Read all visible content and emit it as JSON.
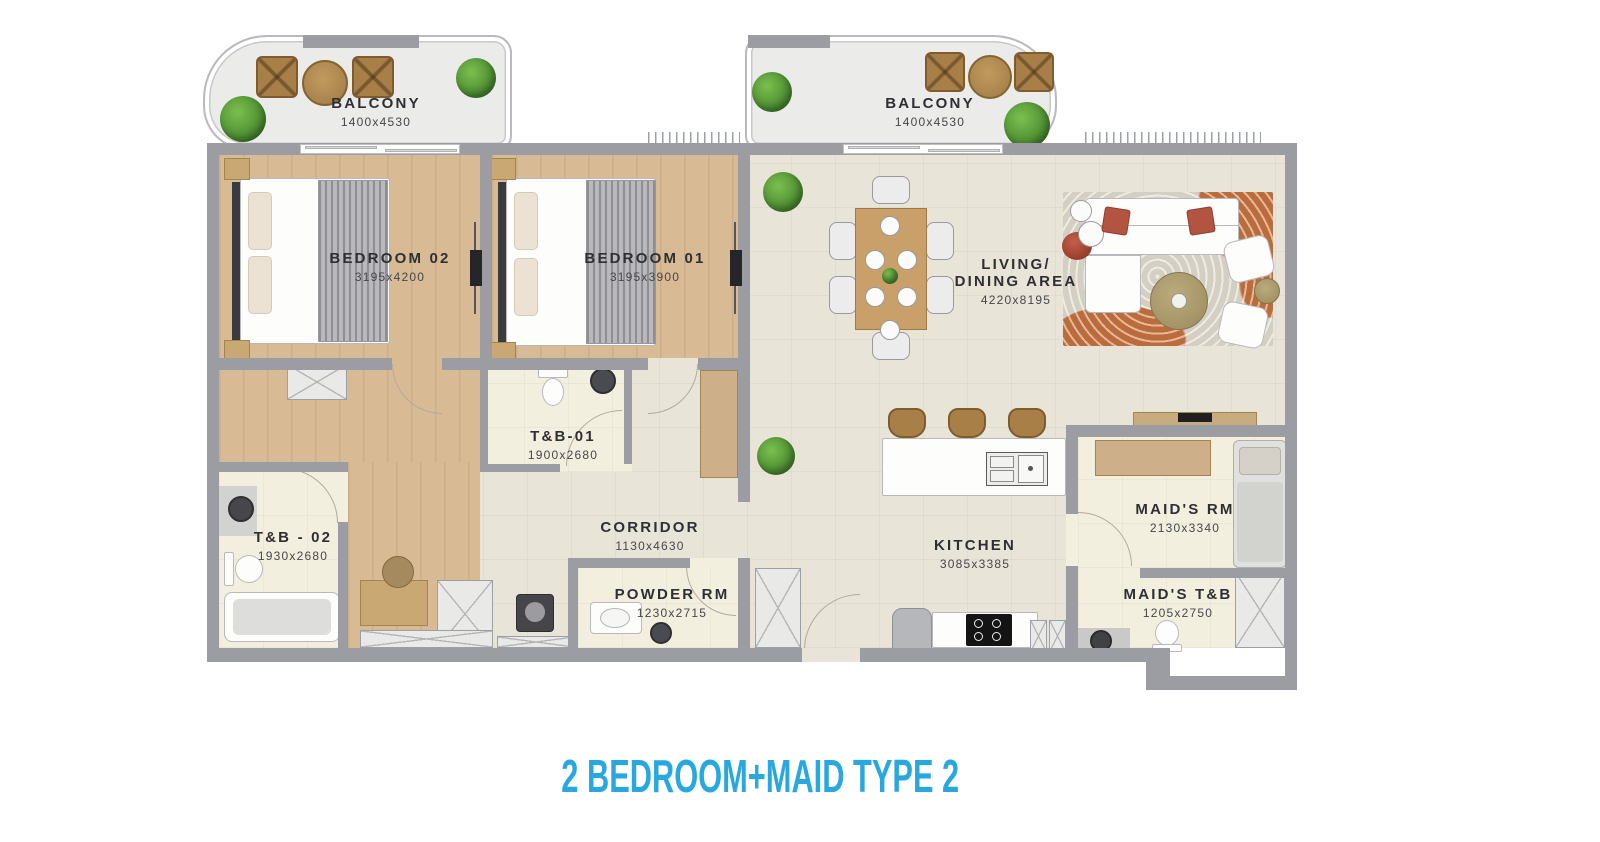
{
  "title": "2 BEDROOM+MAID TYPE 2",
  "rooms": {
    "balcony_left": {
      "label": "BALCONY",
      "dims": "1400x4530"
    },
    "balcony_right": {
      "label": "BALCONY",
      "dims": "1400x4530"
    },
    "bedroom_02": {
      "label": "BEDROOM 02",
      "dims": "3195x4200"
    },
    "bedroom_01": {
      "label": "BEDROOM 01",
      "dims": "3195x3900"
    },
    "living_dining": {
      "label_line1": "LIVING/",
      "label_line2": "DINING AREA",
      "dims": "4220x8195"
    },
    "tb_01": {
      "label": "T&B-01",
      "dims": "1900x2680"
    },
    "tb_02": {
      "label": "T&B - 02",
      "dims": "1930x2680"
    },
    "corridor": {
      "label": "CORRIDOR",
      "dims": "1130x4630"
    },
    "powder_rm": {
      "label": "POWDER RM",
      "dims": "1230x2715"
    },
    "kitchen": {
      "label": "KITCHEN",
      "dims": "3085x3385"
    },
    "maids_rm": {
      "label": "MAID'S RM",
      "dims": "2130x3340"
    },
    "maids_tb": {
      "label": "MAID'S T&B",
      "dims": "1205x2750"
    }
  },
  "colors": {
    "accent_title": "#29a8e0",
    "wall": "#9b9da3",
    "wood_floor": "#d8bb95",
    "living_floor": "#e9e4d8",
    "bath_floor": "#f3efdf",
    "balcony_floor": "#ebebe9",
    "rug_orange": "#c4703c"
  }
}
